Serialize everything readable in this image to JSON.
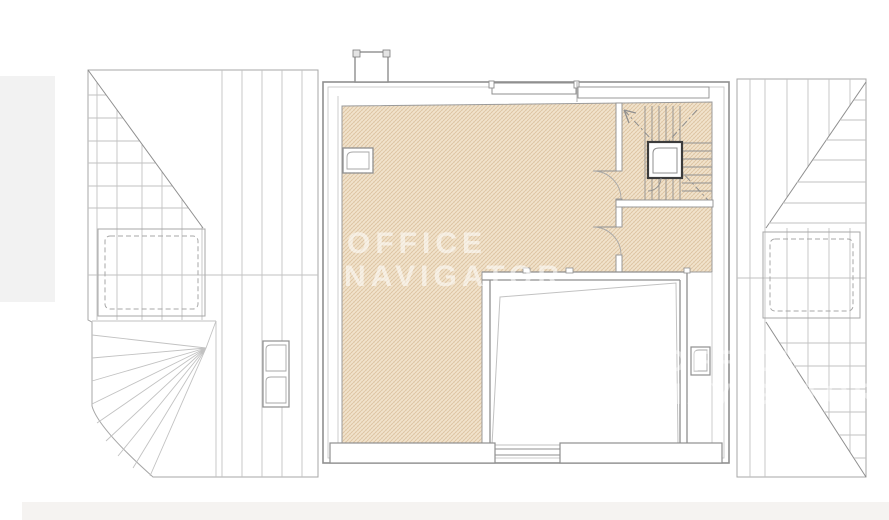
{
  "watermark": {
    "line1": "OFFICE",
    "line2": "NAVIGATOR"
  },
  "colors": {
    "hatch-base": "#f2e4ce",
    "hatch-line": "#dcc3a1",
    "line-gray": "#8f8f8f",
    "line-dark": "#3c3c3c",
    "margin-gray": "#f2f2f2",
    "band-gray": "#f5f3f1",
    "watermark-white": "#ffffff"
  }
}
